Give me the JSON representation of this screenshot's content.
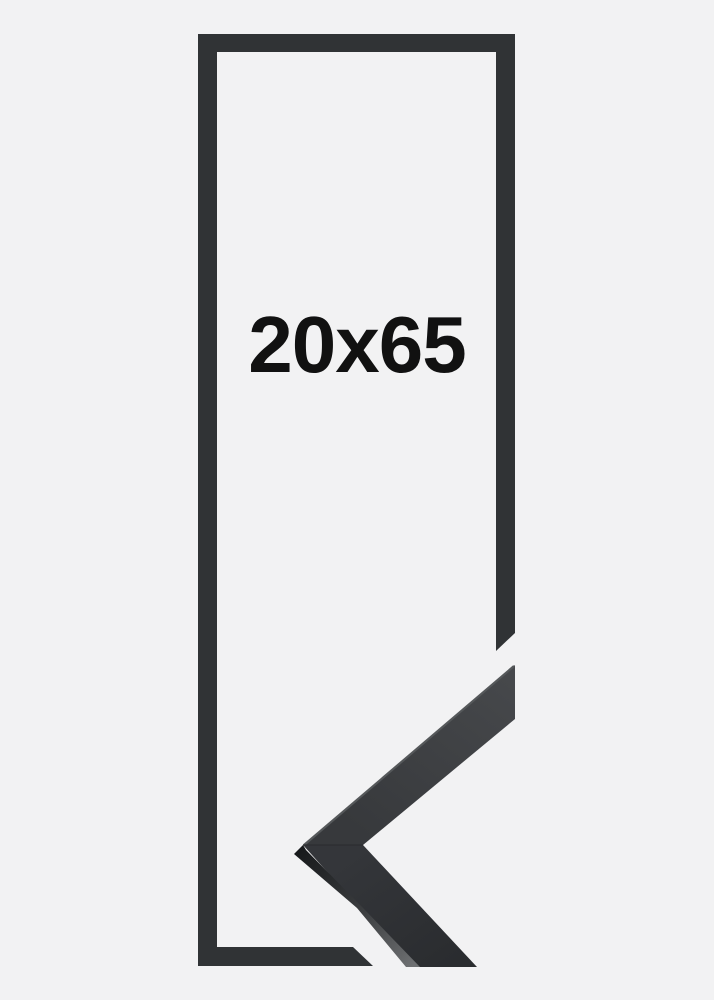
{
  "product": {
    "size_label": "20x65"
  },
  "colors": {
    "background": "#f2f2f3",
    "frame_outline": "#303335",
    "photo_face_top": "#46484b",
    "photo_face_upper_end": "#37393c",
    "photo_face_lower_start": "#34363a",
    "photo_face_bottom": "#2a2c2f",
    "photo_side_dark": "#17191b",
    "photo_side_light": "#6e7072",
    "photo_edge_highlight": "#55585a",
    "label_text": "#111111"
  }
}
